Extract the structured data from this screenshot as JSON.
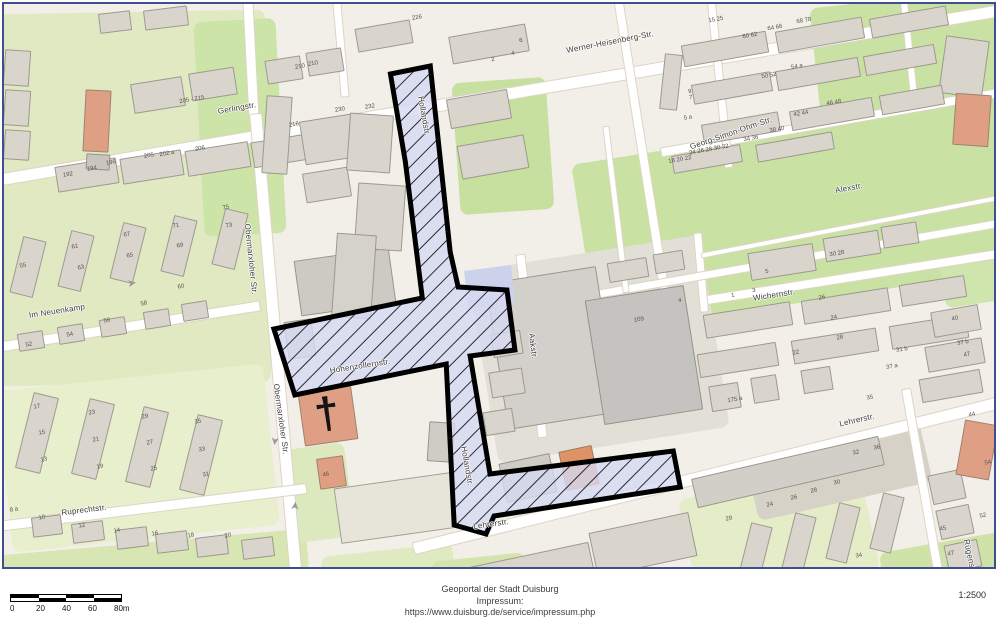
{
  "footer": {
    "portal_line": "Geoportal der Stadt Duisburg",
    "impressum_label": "Impressum:",
    "impressum_url": "https://www.duisburg.de/service/impressum.php",
    "scale_ratio": "1:2500",
    "scalebar_labels": [
      "0",
      "20",
      "40",
      "60",
      "80m"
    ]
  },
  "map": {
    "background": "#f2efe8",
    "border_color": "#3e4e8e",
    "highlight": {
      "fill": "#d6d9f2",
      "hatch_color": "#15151c",
      "stroke": "#000000",
      "outline_width": 5,
      "main_polygon": "388,70 428,62 448,248 456,283 505,286 513,346 468,352 488,470 672,447 679,483 492,512 484,530 452,521 444,360 292,391 271,325 420,294 403,158",
      "plain_polygon": "462,267 509,261 513,299 466,305"
    },
    "street_labels": [
      [
        "Gerlingstr.",
        233,
        104,
        -10
      ],
      [
        "Werner-Heisenberg-Str.",
        606,
        38,
        -11
      ],
      [
        "Georg-Simon-Ohm-Str.",
        727,
        129,
        -19
      ],
      [
        "Alexstr.",
        845,
        184,
        -11
      ],
      [
        "Obermarxloher Str.",
        247,
        255,
        84
      ],
      [
        "Obermarxloher Str.",
        277,
        415,
        82
      ],
      [
        "Im Neuenkamp",
        53,
        307,
        -9
      ],
      [
        "Ruprechtstr.",
        80,
        506,
        -7
      ],
      [
        "Wichernstr.",
        770,
        291,
        -9
      ],
      [
        "Lehrerstr.",
        487,
        520,
        -8
      ],
      [
        "Lehrerstr.",
        853,
        416,
        -13
      ],
      [
        "Hollandstr.",
        420,
        112,
        80
      ],
      [
        "Hollandstr.",
        463,
        462,
        80
      ],
      [
        "Hohenzollernstr.",
        356,
        362,
        -9
      ],
      [
        "Aakstr.",
        529,
        342,
        83
      ],
      [
        "Rügenstr.",
        966,
        553,
        78
      ]
    ],
    "house_numbers": [
      [
        "205 - 215",
        188,
        96
      ],
      [
        "192",
        64,
        171
      ],
      [
        "194",
        88,
        165
      ],
      [
        "196",
        107,
        159
      ],
      [
        "205",
        145,
        152
      ],
      [
        "202 a",
        163,
        150
      ],
      [
        "206",
        196,
        145
      ],
      [
        "216",
        290,
        121
      ],
      [
        "210",
        296,
        63
      ],
      [
        "210",
        309,
        60
      ],
      [
        "226",
        413,
        14
      ],
      [
        "230",
        336,
        106
      ],
      [
        "232",
        366,
        103
      ],
      [
        "2",
        489,
        56
      ],
      [
        "4",
        509,
        50
      ],
      [
        "6",
        517,
        37
      ],
      [
        "55",
        19,
        262
      ],
      [
        "61",
        71,
        243
      ],
      [
        "63",
        77,
        264
      ],
      [
        "65",
        126,
        252
      ],
      [
        "67",
        123,
        231
      ],
      [
        "69",
        176,
        242
      ],
      [
        "71",
        172,
        222
      ],
      [
        "73",
        225,
        222
      ],
      [
        "75",
        222,
        204
      ],
      [
        "52",
        25,
        341
      ],
      [
        "54",
        66,
        331
      ],
      [
        "56",
        103,
        317
      ],
      [
        "58",
        140,
        300
      ],
      [
        "60",
        177,
        283
      ],
      [
        "17",
        33,
        403
      ],
      [
        "15",
        38,
        429
      ],
      [
        "13",
        40,
        456
      ],
      [
        "23",
        88,
        409
      ],
      [
        "21",
        92,
        436
      ],
      [
        "19",
        96,
        463
      ],
      [
        "29",
        141,
        413
      ],
      [
        "27",
        146,
        439
      ],
      [
        "25",
        150,
        465
      ],
      [
        "35",
        194,
        418
      ],
      [
        "33",
        198,
        446
      ],
      [
        "31",
        202,
        471
      ],
      [
        "8 a",
        10,
        506
      ],
      [
        "10",
        38,
        514
      ],
      [
        "12",
        78,
        522
      ],
      [
        "14",
        113,
        527
      ],
      [
        "16",
        151,
        530
      ],
      [
        "18",
        187,
        532
      ],
      [
        "20",
        224,
        532
      ],
      [
        "46",
        322,
        471
      ],
      [
        "109",
        635,
        316
      ],
      [
        "60 62",
        746,
        32
      ],
      [
        "64 66",
        771,
        24
      ],
      [
        "68 78",
        800,
        17
      ],
      [
        "50 52",
        765,
        72
      ],
      [
        "54 a",
        793,
        63
      ],
      [
        "42 44",
        797,
        110
      ],
      [
        "46 48",
        830,
        99
      ],
      [
        "38 40",
        773,
        126
      ],
      [
        "34 36",
        747,
        135
      ],
      [
        "24 26 28 30 32",
        705,
        146
      ],
      [
        "18 20 22",
        676,
        156
      ],
      [
        "5 a",
        684,
        114
      ],
      [
        "7",
        687,
        94
      ],
      [
        "9",
        686,
        88
      ],
      [
        "15 25",
        712,
        16
      ],
      [
        "1",
        729,
        292
      ],
      [
        "3",
        750,
        287
      ],
      [
        "5",
        763,
        268
      ],
      [
        "4",
        676,
        297
      ],
      [
        "30 28",
        833,
        250
      ],
      [
        "26",
        818,
        294
      ],
      [
        "24",
        830,
        314
      ],
      [
        "28",
        836,
        334
      ],
      [
        "22",
        792,
        349
      ],
      [
        "40",
        951,
        315
      ],
      [
        "37 b",
        959,
        339
      ],
      [
        "47",
        963,
        351
      ],
      [
        "31 b",
        898,
        346
      ],
      [
        "37 a",
        888,
        363
      ],
      [
        "35",
        866,
        394
      ],
      [
        "175 a",
        731,
        396
      ],
      [
        "29",
        725,
        515
      ],
      [
        "24",
        766,
        501
      ],
      [
        "26",
        790,
        494
      ],
      [
        "28",
        810,
        487
      ],
      [
        "30",
        833,
        479
      ],
      [
        "32",
        852,
        449
      ],
      [
        "36",
        873,
        444
      ],
      [
        "44",
        968,
        411
      ],
      [
        "54",
        984,
        459
      ],
      [
        "52",
        979,
        512
      ],
      [
        "45",
        939,
        525
      ],
      [
        "47",
        947,
        550
      ],
      [
        "34",
        855,
        552
      ]
    ],
    "roads": [
      [
        500,
        90,
        1035,
        13,
        -9.6
      ],
      [
        247,
        56,
        118,
        11,
        87
      ],
      [
        272,
        342,
        468,
        13,
        85
      ],
      [
        125,
        322,
        265,
        11,
        -9
      ],
      [
        148,
        503,
        312,
        11,
        -7
      ],
      [
        707,
        470,
        615,
        13,
        -14
      ],
      [
        527,
        342,
        185,
        10,
        83
      ],
      [
        638,
        145,
        298,
        10,
        81
      ],
      [
        830,
        118,
        352,
        10,
        -10
      ],
      [
        855,
        272,
        312,
        10,
        -9
      ],
      [
        697,
        268,
        80,
        9,
        85
      ],
      [
        920,
        487,
        208,
        10,
        80
      ],
      [
        790,
        255,
        445,
        9,
        -10
      ],
      [
        612,
        205,
        168,
        7,
        83
      ],
      [
        850,
        222,
        312,
        6,
        -11
      ],
      [
        337,
        45,
        96,
        9,
        85
      ],
      [
        716,
        80,
        168,
        9,
        84
      ],
      [
        905,
        45,
        96,
        8,
        84
      ]
    ],
    "areas": [
      [
        -8,
        8,
        272,
        372,
        -1,
        "#e0e9c2"
      ],
      [
        195,
        16,
        82,
        215,
        -3,
        "#cde4a9"
      ],
      [
        452,
        76,
        94,
        132,
        -4,
        "#c7e0a0"
      ],
      [
        638,
        250,
        60,
        54,
        -8,
        "#c9e2a4"
      ],
      [
        578,
        126,
        432,
        172,
        -9,
        "#c9e2a3"
      ],
      [
        812,
        -6,
        192,
        136,
        -6,
        "#c9e2a3"
      ],
      [
        938,
        250,
        62,
        50,
        -9,
        "#cfe5ad"
      ],
      [
        0,
        373,
        268,
        162,
        -6,
        "#e7efcd"
      ],
      [
        -4,
        538,
        308,
        42,
        -5,
        "#d7e6b2"
      ],
      [
        318,
        546,
        132,
        34,
        -6,
        "#dfeac0"
      ],
      [
        683,
        476,
        184,
        108,
        -12,
        "#e4edc8"
      ],
      [
        878,
        538,
        124,
        48,
        -10,
        "#cfe3a9"
      ],
      [
        282,
        442,
        64,
        94,
        -8,
        "#dce8bd"
      ],
      [
        428,
        553,
        94,
        32,
        -6,
        "#d4e4ad"
      ],
      [
        478,
        248,
        234,
        194,
        -9,
        "#e2dfd6"
      ],
      [
        746,
        436,
        178,
        62,
        -13,
        "#d6d2c8"
      ]
    ],
    "buildings": [
      [
        128,
        76,
        52,
        30,
        -9
      ],
      [
        186,
        66,
        46,
        28,
        -9
      ],
      [
        95,
        8,
        32,
        20,
        -7
      ],
      [
        140,
        4,
        44,
        20,
        -7
      ],
      [
        52,
        158,
        62,
        26,
        -9
      ],
      [
        117,
        150,
        62,
        26,
        -9
      ],
      [
        182,
        142,
        64,
        26,
        -9
      ],
      [
        248,
        134,
        56,
        26,
        -9
      ],
      [
        0,
        46,
        26,
        36,
        4
      ],
      [
        0,
        86,
        26,
        36,
        4
      ],
      [
        0,
        126,
        26,
        30,
        4
      ],
      [
        80,
        86,
        26,
        62,
        3,
        "#de9f84"
      ],
      [
        82,
        150,
        24,
        16,
        3,
        "#c9c5bd"
      ],
      [
        262,
        54,
        36,
        24,
        -9
      ],
      [
        303,
        46,
        36,
        24,
        -9
      ],
      [
        260,
        92,
        26,
        78,
        4
      ],
      [
        298,
        113,
        58,
        44,
        -9
      ],
      [
        300,
        166,
        46,
        30,
        -9
      ],
      [
        293,
        250,
        96,
        56,
        -8,
        "#cdcac4"
      ],
      [
        282,
        316,
        28,
        38,
        -8,
        "#d2cfc9"
      ],
      [
        344,
        110,
        44,
        58,
        4
      ],
      [
        352,
        180,
        48,
        66,
        4
      ],
      [
        330,
        230,
        40,
        84,
        4,
        "#d5d2cb"
      ],
      [
        446,
        26,
        78,
        28,
        -10
      ],
      [
        352,
        20,
        56,
        24,
        -10
      ],
      [
        444,
        90,
        62,
        30,
        -10
      ],
      [
        455,
        136,
        68,
        34,
        -10
      ],
      [
        297,
        385,
        54,
        54,
        -8,
        "#de9f84"
      ],
      [
        314,
        453,
        27,
        31,
        -8,
        "#de9f84"
      ],
      [
        333,
        476,
        118,
        56,
        -8,
        "#e7e4d9"
      ],
      [
        424,
        418,
        26,
        40,
        4,
        "#cfccc6"
      ],
      [
        492,
        270,
        112,
        148,
        -9,
        "#d2d0cb"
      ],
      [
        590,
        288,
        100,
        126,
        -9,
        "#c5c3c0"
      ],
      [
        488,
        328,
        30,
        24,
        -9
      ],
      [
        486,
        366,
        34,
        26,
        -9
      ],
      [
        480,
        406,
        30,
        24,
        -9
      ],
      [
        745,
        244,
        66,
        28,
        -9
      ],
      [
        820,
        230,
        56,
        24,
        -9
      ],
      [
        878,
        220,
        36,
        22,
        -9
      ],
      [
        938,
        34,
        44,
        58,
        8
      ],
      [
        950,
        90,
        36,
        52,
        4,
        "#de9f84"
      ],
      [
        678,
        34,
        86,
        22,
        -10
      ],
      [
        772,
        20,
        88,
        22,
        -10
      ],
      [
        866,
        8,
        78,
        20,
        -10
      ],
      [
        688,
        74,
        80,
        20,
        -10
      ],
      [
        772,
        60,
        84,
        20,
        -10
      ],
      [
        860,
        46,
        72,
        20,
        -10
      ],
      [
        698,
        114,
        78,
        20,
        -10
      ],
      [
        786,
        100,
        84,
        20,
        -10
      ],
      [
        876,
        86,
        64,
        20,
        -10
      ],
      [
        668,
        146,
        70,
        18,
        -10
      ],
      [
        752,
        134,
        78,
        18,
        -10
      ],
      [
        658,
        50,
        18,
        56,
        6
      ],
      [
        700,
        304,
        88,
        24,
        -9
      ],
      [
        798,
        290,
        88,
        24,
        -9
      ],
      [
        896,
        276,
        66,
        22,
        -9
      ],
      [
        694,
        344,
        80,
        24,
        -9
      ],
      [
        788,
        330,
        86,
        24,
        -9
      ],
      [
        886,
        316,
        78,
        24,
        -9
      ],
      [
        706,
        380,
        30,
        26,
        -9
      ],
      [
        748,
        372,
        26,
        26,
        -9
      ],
      [
        798,
        364,
        30,
        24,
        -9
      ],
      [
        928,
        304,
        48,
        26,
        -10
      ],
      [
        922,
        338,
        58,
        26,
        -10
      ],
      [
        916,
        370,
        62,
        24,
        -10
      ],
      [
        558,
        444,
        34,
        40,
        -12,
        "#dd9366"
      ],
      [
        498,
        454,
        52,
        40,
        -12,
        "#cfccc6"
      ],
      [
        688,
        453,
        192,
        30,
        -13,
        "#d2cfc8"
      ],
      [
        588,
        518,
        102,
        45,
        -12
      ],
      [
        468,
        550,
        122,
        42,
        -12
      ],
      [
        740,
        520,
        22,
        58,
        14
      ],
      [
        784,
        510,
        22,
        58,
        14
      ],
      [
        828,
        500,
        22,
        58,
        14
      ],
      [
        872,
        490,
        22,
        58,
        14
      ],
      [
        926,
        468,
        34,
        30,
        -12
      ],
      [
        934,
        503,
        34,
        30,
        -12
      ],
      [
        942,
        538,
        34,
        28,
        -12
      ],
      [
        956,
        418,
        34,
        56,
        10,
        "#de9f84"
      ],
      [
        20,
        390,
        26,
        78,
        14
      ],
      [
        76,
        396,
        26,
        78,
        14
      ],
      [
        130,
        404,
        26,
        78,
        14
      ],
      [
        184,
        412,
        26,
        78,
        14
      ],
      [
        28,
        512,
        30,
        20,
        -7
      ],
      [
        68,
        518,
        32,
        20,
        -7
      ],
      [
        112,
        524,
        32,
        20,
        -7
      ],
      [
        152,
        528,
        32,
        20,
        -7
      ],
      [
        192,
        532,
        32,
        20,
        -7
      ],
      [
        238,
        534,
        32,
        20,
        -7
      ],
      [
        12,
        234,
        24,
        58,
        14
      ],
      [
        60,
        228,
        24,
        58,
        14
      ],
      [
        112,
        220,
        24,
        58,
        14
      ],
      [
        163,
        213,
        24,
        58,
        14
      ],
      [
        214,
        206,
        24,
        58,
        14
      ],
      [
        14,
        328,
        26,
        18,
        -9
      ],
      [
        54,
        321,
        26,
        18,
        -9
      ],
      [
        96,
        314,
        26,
        18,
        -9
      ],
      [
        140,
        306,
        26,
        18,
        -9
      ],
      [
        178,
        298,
        26,
        18,
        -9
      ],
      [
        604,
        256,
        40,
        20,
        -9
      ],
      [
        650,
        248,
        30,
        20,
        -9
      ]
    ],
    "arrows": [
      [
        128,
        280,
        -9
      ],
      [
        270,
        437,
        96
      ],
      [
        292,
        502,
        -85
      ]
    ],
    "church_cross": {
      "glyph": "†",
      "x": 323,
      "y": 410,
      "r": -8
    }
  }
}
